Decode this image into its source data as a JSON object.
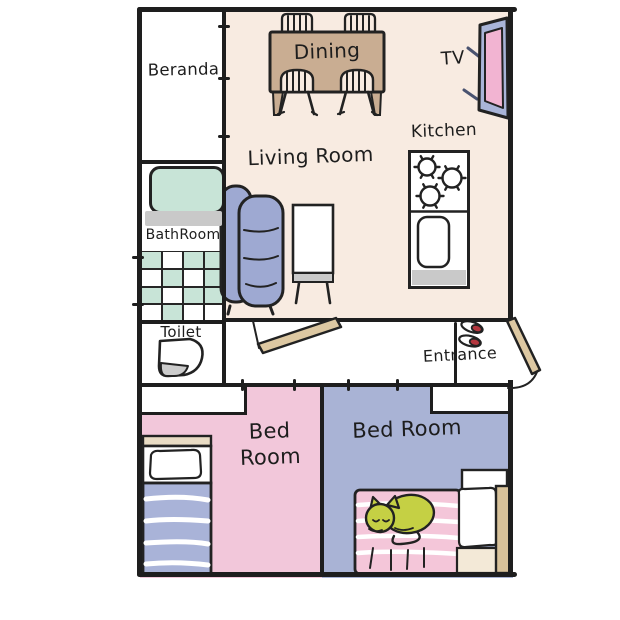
{
  "floorplan": {
    "rooms": {
      "beranda": {
        "label": "Beranda"
      },
      "living_room": {
        "label": "Living Room"
      },
      "dining": {
        "label": "Dining"
      },
      "kitchen": {
        "label": "Kitchen"
      },
      "tv": {
        "label": "TV"
      },
      "bathroom": {
        "label": "BathRoom"
      },
      "toilet": {
        "label": "Toilet"
      },
      "entrance": {
        "label": "Entrance"
      },
      "bedroom_left": {
        "label_line1": "Bed",
        "label_line2": "Room"
      },
      "bedroom_right": {
        "label": "Bed Room"
      }
    },
    "colors": {
      "wall": "#1e1e1e",
      "living_floor": "#f8ebe1",
      "bedroom_left_floor": "#f2c7da",
      "bedroom_right_floor": "#a9b3d5",
      "sofa": "#9ea9d2",
      "dining_table": "#c9ad92",
      "door": "#ddc8a2",
      "bathtub_mint": "#c8e4d7",
      "tv_frame": "#a9b4d8",
      "tv_screen": "#f2b4d2",
      "bed_blanket_blue": "#a9b3d8",
      "bed_blanket_pink": "#f4c6d9",
      "cat": "#c5d044",
      "shoes": "#b5373f",
      "counter_gray": "#c9c9c9"
    }
  }
}
